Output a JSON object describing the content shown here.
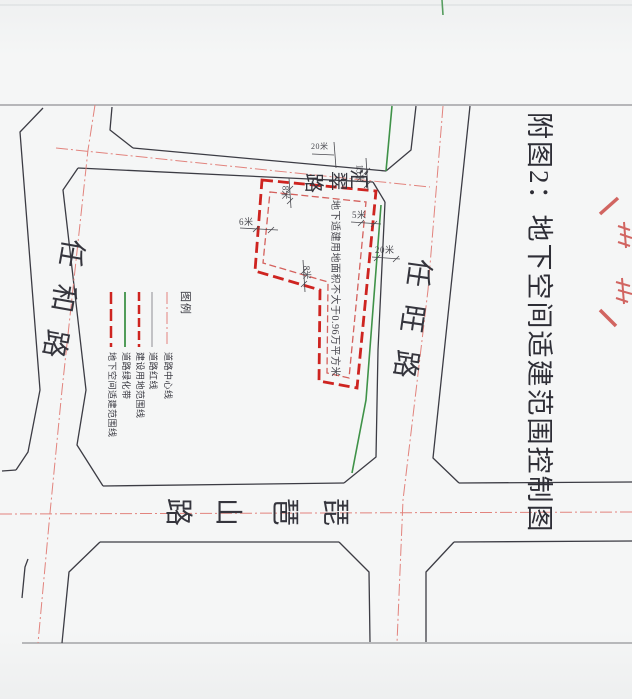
{
  "page": {
    "title": "附图2：地下空间适建范围控制图"
  },
  "map": {
    "roads": {
      "renhe": {
        "name": "任和路"
      },
      "renwang": {
        "name": "任旺路"
      },
      "huicui": {
        "name": "汇翠路",
        "chars": [
          "汇",
          "翠",
          "路"
        ]
      },
      "pipashan": {
        "name": "琵琶山路",
        "chars": [
          "琵",
          "琶",
          "山",
          "路"
        ]
      }
    },
    "parcel_note": "地下适建用地面积不大于0.96万平方米",
    "dims": {
      "left_offset": "6米",
      "top_offset": "8米",
      "right_offset": "5米",
      "road_clearance": "20米",
      "corner_offset": "15米",
      "step_offset": "8米",
      "road_width": "20米"
    }
  },
  "legend": {
    "title": "图例",
    "items": [
      {
        "label": "道路中心线",
        "style": "dash-dot-thin",
        "color": "#e2837d"
      },
      {
        "label": "道路红线",
        "style": "solid-thin",
        "color": "#8f8f94"
      },
      {
        "label": "建设用地范围线",
        "style": "dashed-bold",
        "color": "#ce2420"
      },
      {
        "label": "道路绿化带",
        "style": "solid",
        "color": "#3f9248"
      },
      {
        "label": "地下空间适建范围线",
        "style": "dashed-bold",
        "color": "#ce2420"
      }
    ]
  },
  "stamp": {
    "name": "red-seal-fragment"
  },
  "colors": {
    "paper": "#f5f6f6",
    "ink": "#3c3c44",
    "frame": "#77777c",
    "centerline": "#e2837d",
    "red": "#ce2420",
    "redlight": "#d4605c",
    "green": "#3f9248",
    "dim": "#4a4a50",
    "seal": "#c9413d"
  }
}
